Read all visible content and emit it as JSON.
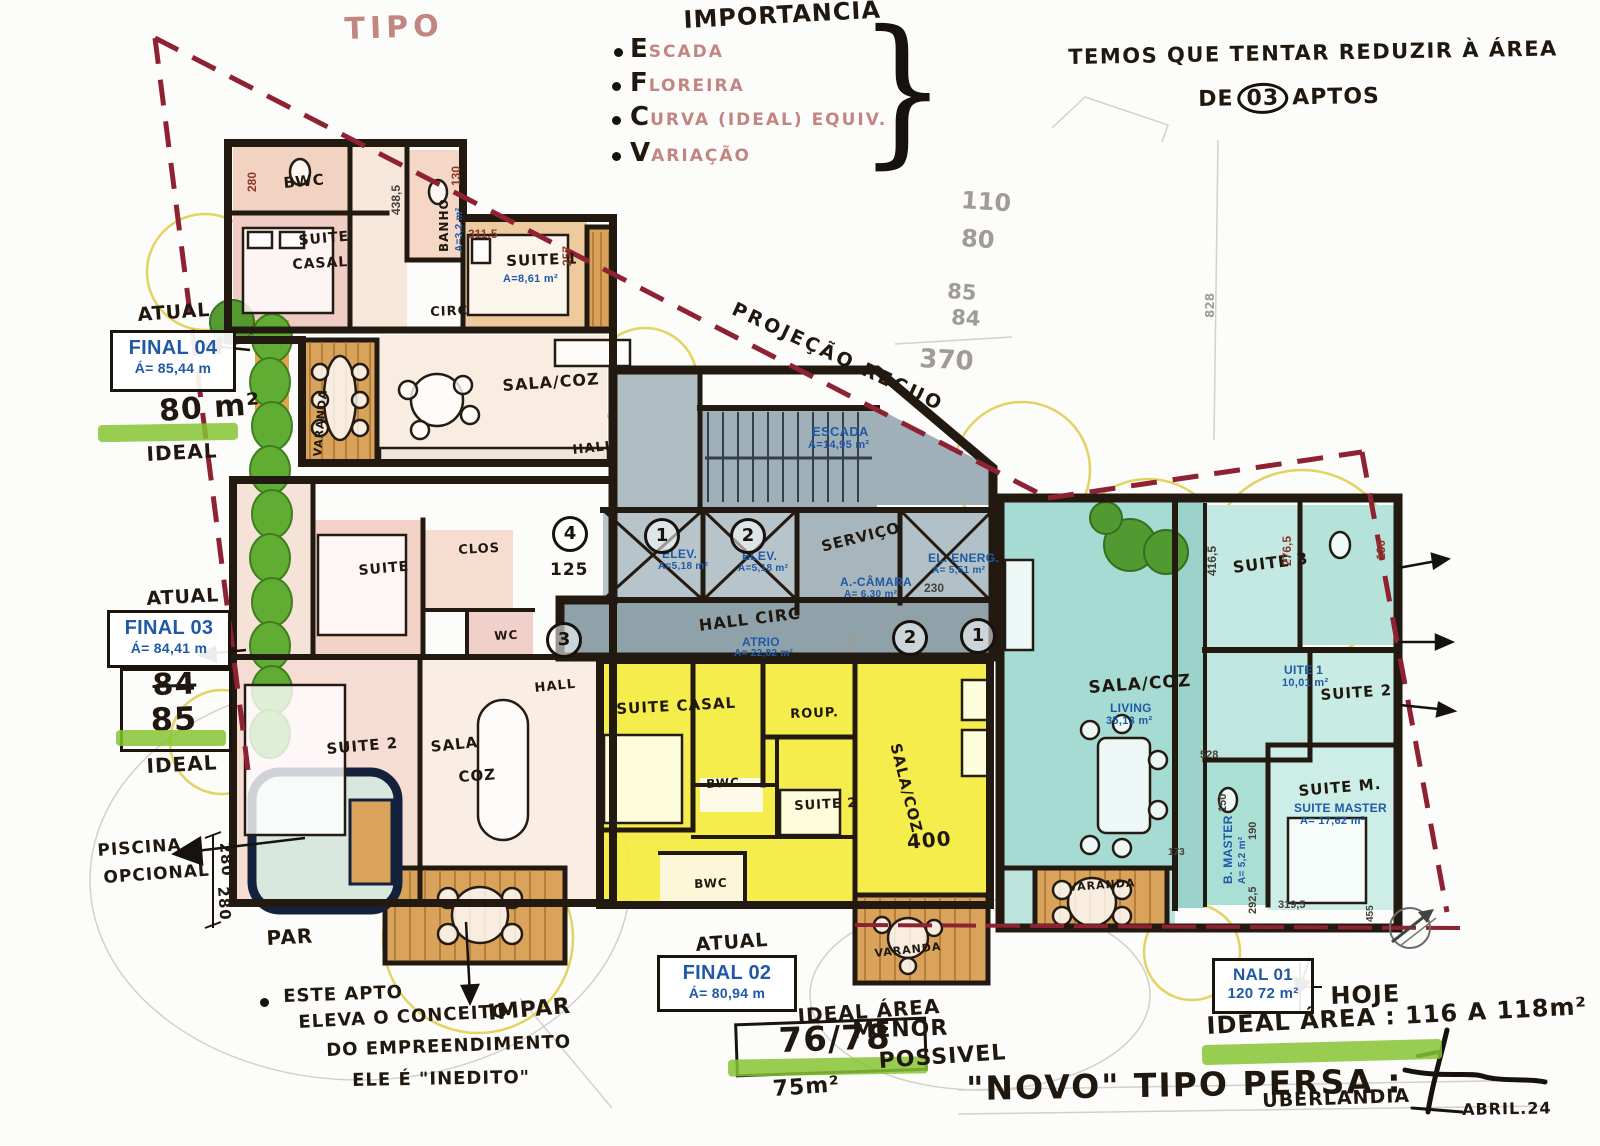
{
  "meta": {
    "title_main": "\"NOVO\" TIPO PERSA :",
    "title_city": "UBERLANDIA",
    "date": "ABRIL.24"
  },
  "colors": {
    "wall": "#221a10",
    "red_dash": "#8e2233",
    "blue_print": "#2059a6",
    "yellow_unit": "#f4ec3d",
    "teal_unit": "#a6dbd3",
    "peach_unit": "#f3d2c0",
    "gray_core": "#9fb0b8",
    "wood_deck": "#d9a35c",
    "green_highlight": "#86c433",
    "green_tree": "#4c9729"
  },
  "notes": {
    "tipo": "TIPO",
    "importancia": {
      "title": "IMPORTANCIA",
      "brace": "}",
      "items": [
        {
          "letter": "E",
          "word": "SCADA"
        },
        {
          "letter": "F",
          "word": "LOREIRA"
        },
        {
          "letter": "C",
          "word": "URVA (IDEAL) EQUIV."
        },
        {
          "letter": "V",
          "word": "ARIAÇÃO"
        }
      ]
    },
    "reduce": {
      "line1": "TEMOS QUE TENTAR REDUZIR À ÁREA",
      "pre": "DE",
      "circled": "03",
      "post": "APTOS"
    },
    "projecao": "PROJEÇÃO RECUO",
    "pencil": {
      "n1": "110",
      "n2": "80",
      "n3": "85",
      "n4": "84",
      "n5": "370"
    },
    "piscina": {
      "l1": "PISCINA",
      "l2": "OPCIONAL",
      "d1": "280",
      "d2": "280",
      "par": "PAR"
    },
    "impar_note": {
      "l1": "ESTE APTO",
      "l2": "ELEVA O CONCEITO",
      "l3": "DO EMPREENDIMENTO",
      "l4": "ELE É \"INEDITO\"",
      "impar": "IMPAR"
    },
    "menor": {
      "l1": "MENOR",
      "l2": "POSSIVEL"
    },
    "hoje": "HOJE"
  },
  "finals": {
    "f04": {
      "atual": "ATUAL",
      "code": "FINAL 04",
      "area": "Á= 85,44 m",
      "ideal_value": "80 m²",
      "ideal": "IDEAL"
    },
    "f03": {
      "atual": "ATUAL",
      "code": "FINAL 03",
      "area": "Á= 84,41 m",
      "v1": "84",
      "v2": "85",
      "ideal": "IDEAL"
    },
    "f02": {
      "atual": "ATUAL",
      "code": "FINAL 02",
      "area": "Á= 80,94 m",
      "ideal_label": "IDEAL ÁREA",
      "values": "76/78",
      "below": "75m²"
    },
    "f01": {
      "code": "NAL 01",
      "area": "120 72 m²",
      "ideal": "IDEAL ÁREA : 116 A 118m²"
    }
  },
  "rooms": {
    "bwc_04": "BWC",
    "suite_04a": "SUITE",
    "suite_04b": "CASAL",
    "banho_04": "BANHO",
    "banho_04_area": "A=3,2 m²",
    "suite1_04": "SUITE 1",
    "suite1_04_area": "A=8,61 m²",
    "circ_04": "CIRC",
    "sala_coz_04": "SALA/COZ",
    "hall_04": "HALL",
    "varanda_04": "VARANDA",
    "escada": "ESCADA",
    "escada_area": "A=14,95 m²",
    "elev": "ELEV.",
    "elev_area": "A=5,18 m²",
    "servico": "SERVIÇO",
    "camara": "A.-CÂMARA",
    "camara_area": "A= 6,30 m²",
    "el_energ": "EL. ENERG.",
    "el_energ_area": "A= 5,51 m²",
    "hall_circ": "HALL CIRC",
    "atrio": "ATRIO",
    "atrio_area": "A= 22,82 m²",
    "suite_03": "SUITE",
    "clos_03": "CLOS",
    "wc_03": "WC",
    "hall_03": "HALL",
    "suite2_03": "SUITE 2",
    "sala_03": "SALA",
    "coz_03": "COZ",
    "suite_casal_02": "SUITE CASAL",
    "roup_02": "ROUP.",
    "bwc_02": "BWC",
    "suite2_02": "SUITE 2",
    "sala_coz_02": "SALA/COZ",
    "bwc2_02": "BWC",
    "varanda_02a": "VARANDA",
    "varanda_02b": "VARANDA",
    "sala_coz_01": "SALA/COZ",
    "living_01": "LIVING",
    "living_01_area": "35,13 m²",
    "suite3_01": "SUITE 3",
    "suite1_01": "UITE 1",
    "suite1_01_area": "10,01 m²",
    "suite2_01": "SUITE 2",
    "suite_m_01": "SUITE M.",
    "suite_master_01": "SUITE MASTER",
    "suite_master_01_area": "A= 17,62 m²",
    "b_master_01": "B. MASTER",
    "b_master_01_area": "A= 5,2 m²"
  },
  "dims": {
    "d438": "438,5",
    "d311": "311,5",
    "d257": "257",
    "d130a": "130",
    "d280a": "280",
    "d125": "125",
    "d230": "230",
    "d276": "276,5",
    "d130b": "130",
    "d416": "416,5",
    "d528": "528",
    "d150a": "150",
    "d190": "190",
    "d292": "292,5",
    "d319": "319,5",
    "d173": "173",
    "d455": "455",
    "d400": "400",
    "d828": "828",
    "d52": "52"
  },
  "circled": {
    "c4": "4",
    "c1": "1",
    "c2": "2",
    "c3": "3",
    "c2b": "2",
    "c1b": "1"
  }
}
